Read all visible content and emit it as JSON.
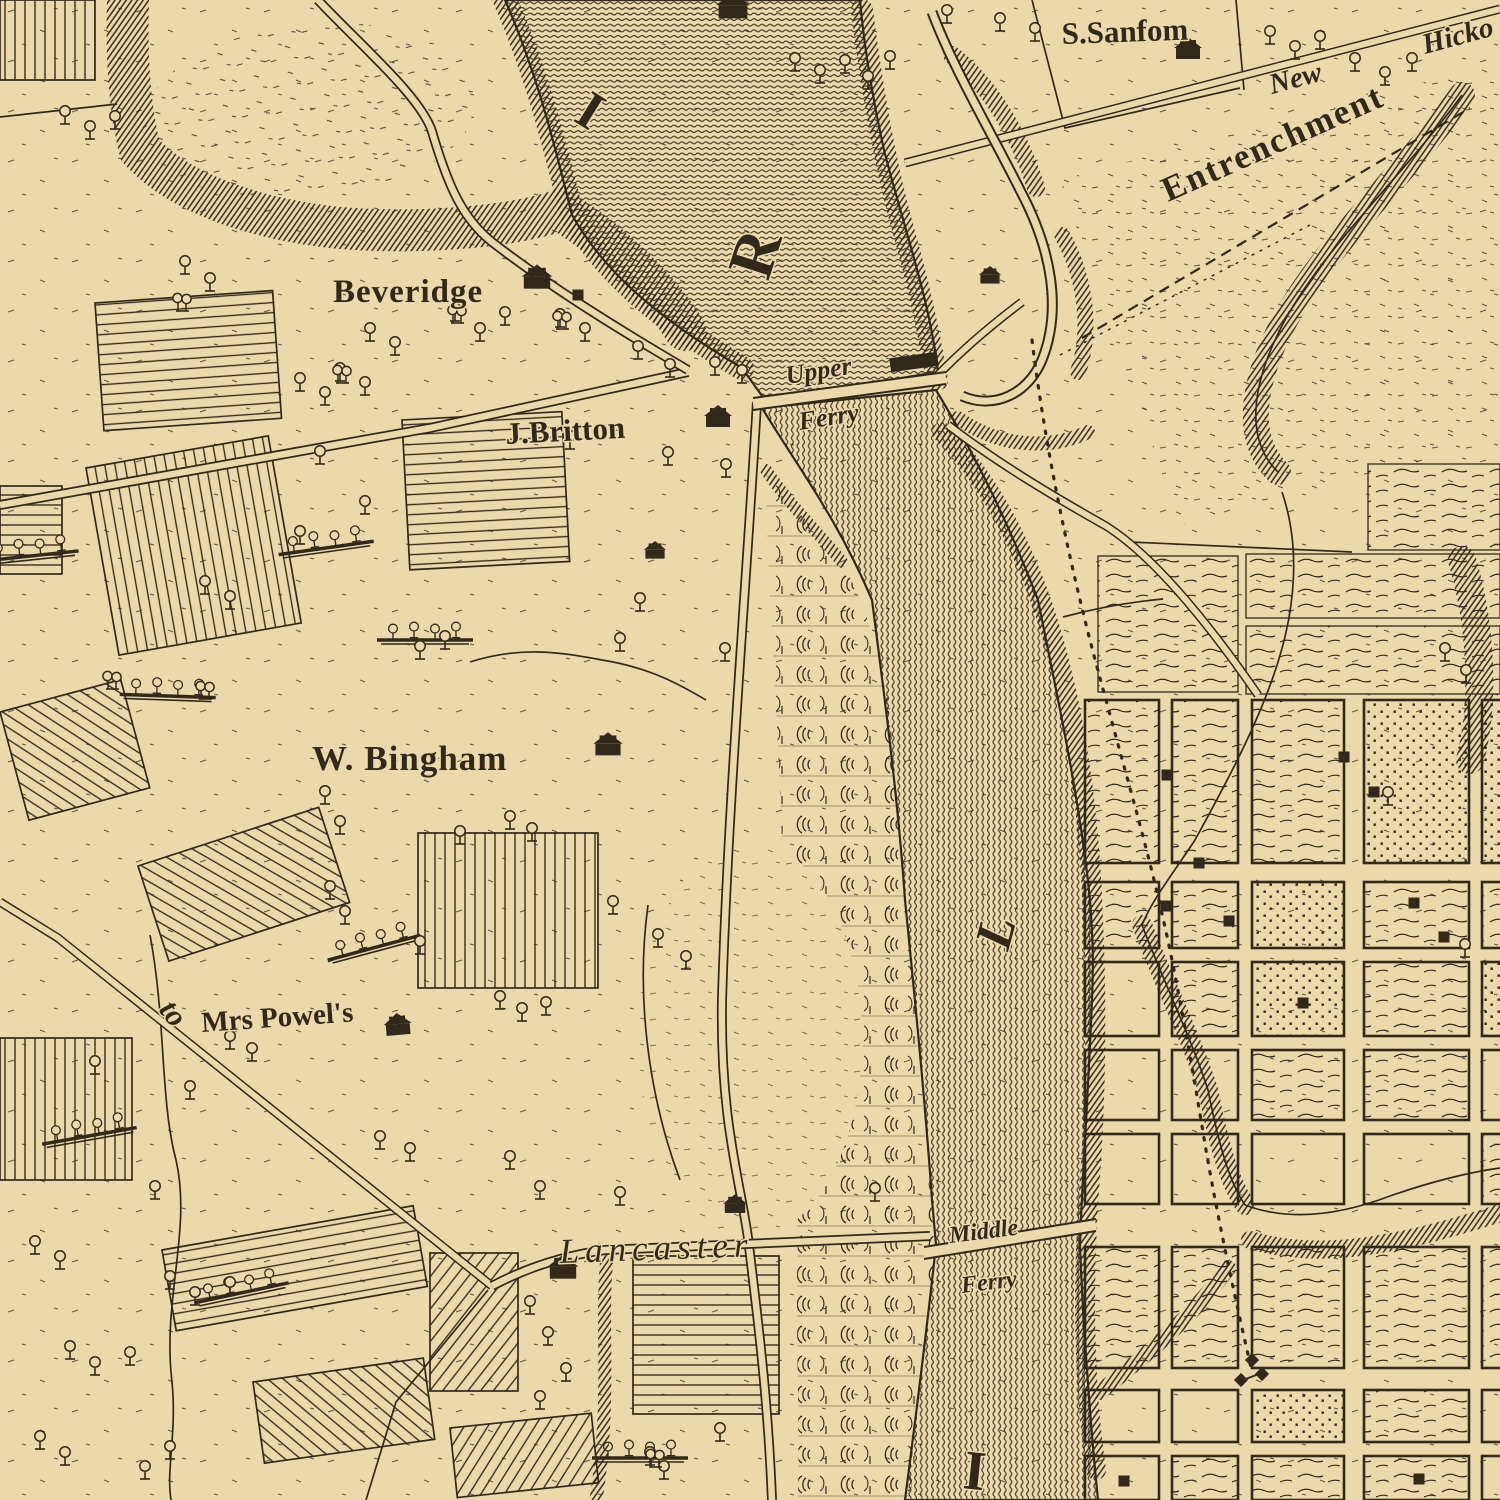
{
  "palette": {
    "paper": "#ecd9ab",
    "ink": "#33291a"
  },
  "labels": {
    "beveridge": "Beveridge",
    "j_britton": "J.Britton",
    "upper_ferry_1": "Upper",
    "upper_ferry_2": "Ferry",
    "w_bingham": "W. Bingham",
    "mrs_powels": "Mrs Powel's",
    "to": "to",
    "lancaster": "Lancaster",
    "middle_ferry_1": "Middle",
    "middle_ferry_2": "Ferry",
    "s_sansom": "S.Sanfom",
    "new_road": "New",
    "hickory_road": "Hicko",
    "entrenchment": "Entrenchment"
  },
  "river_letters": [
    "I",
    "R",
    "L",
    "I"
  ]
}
